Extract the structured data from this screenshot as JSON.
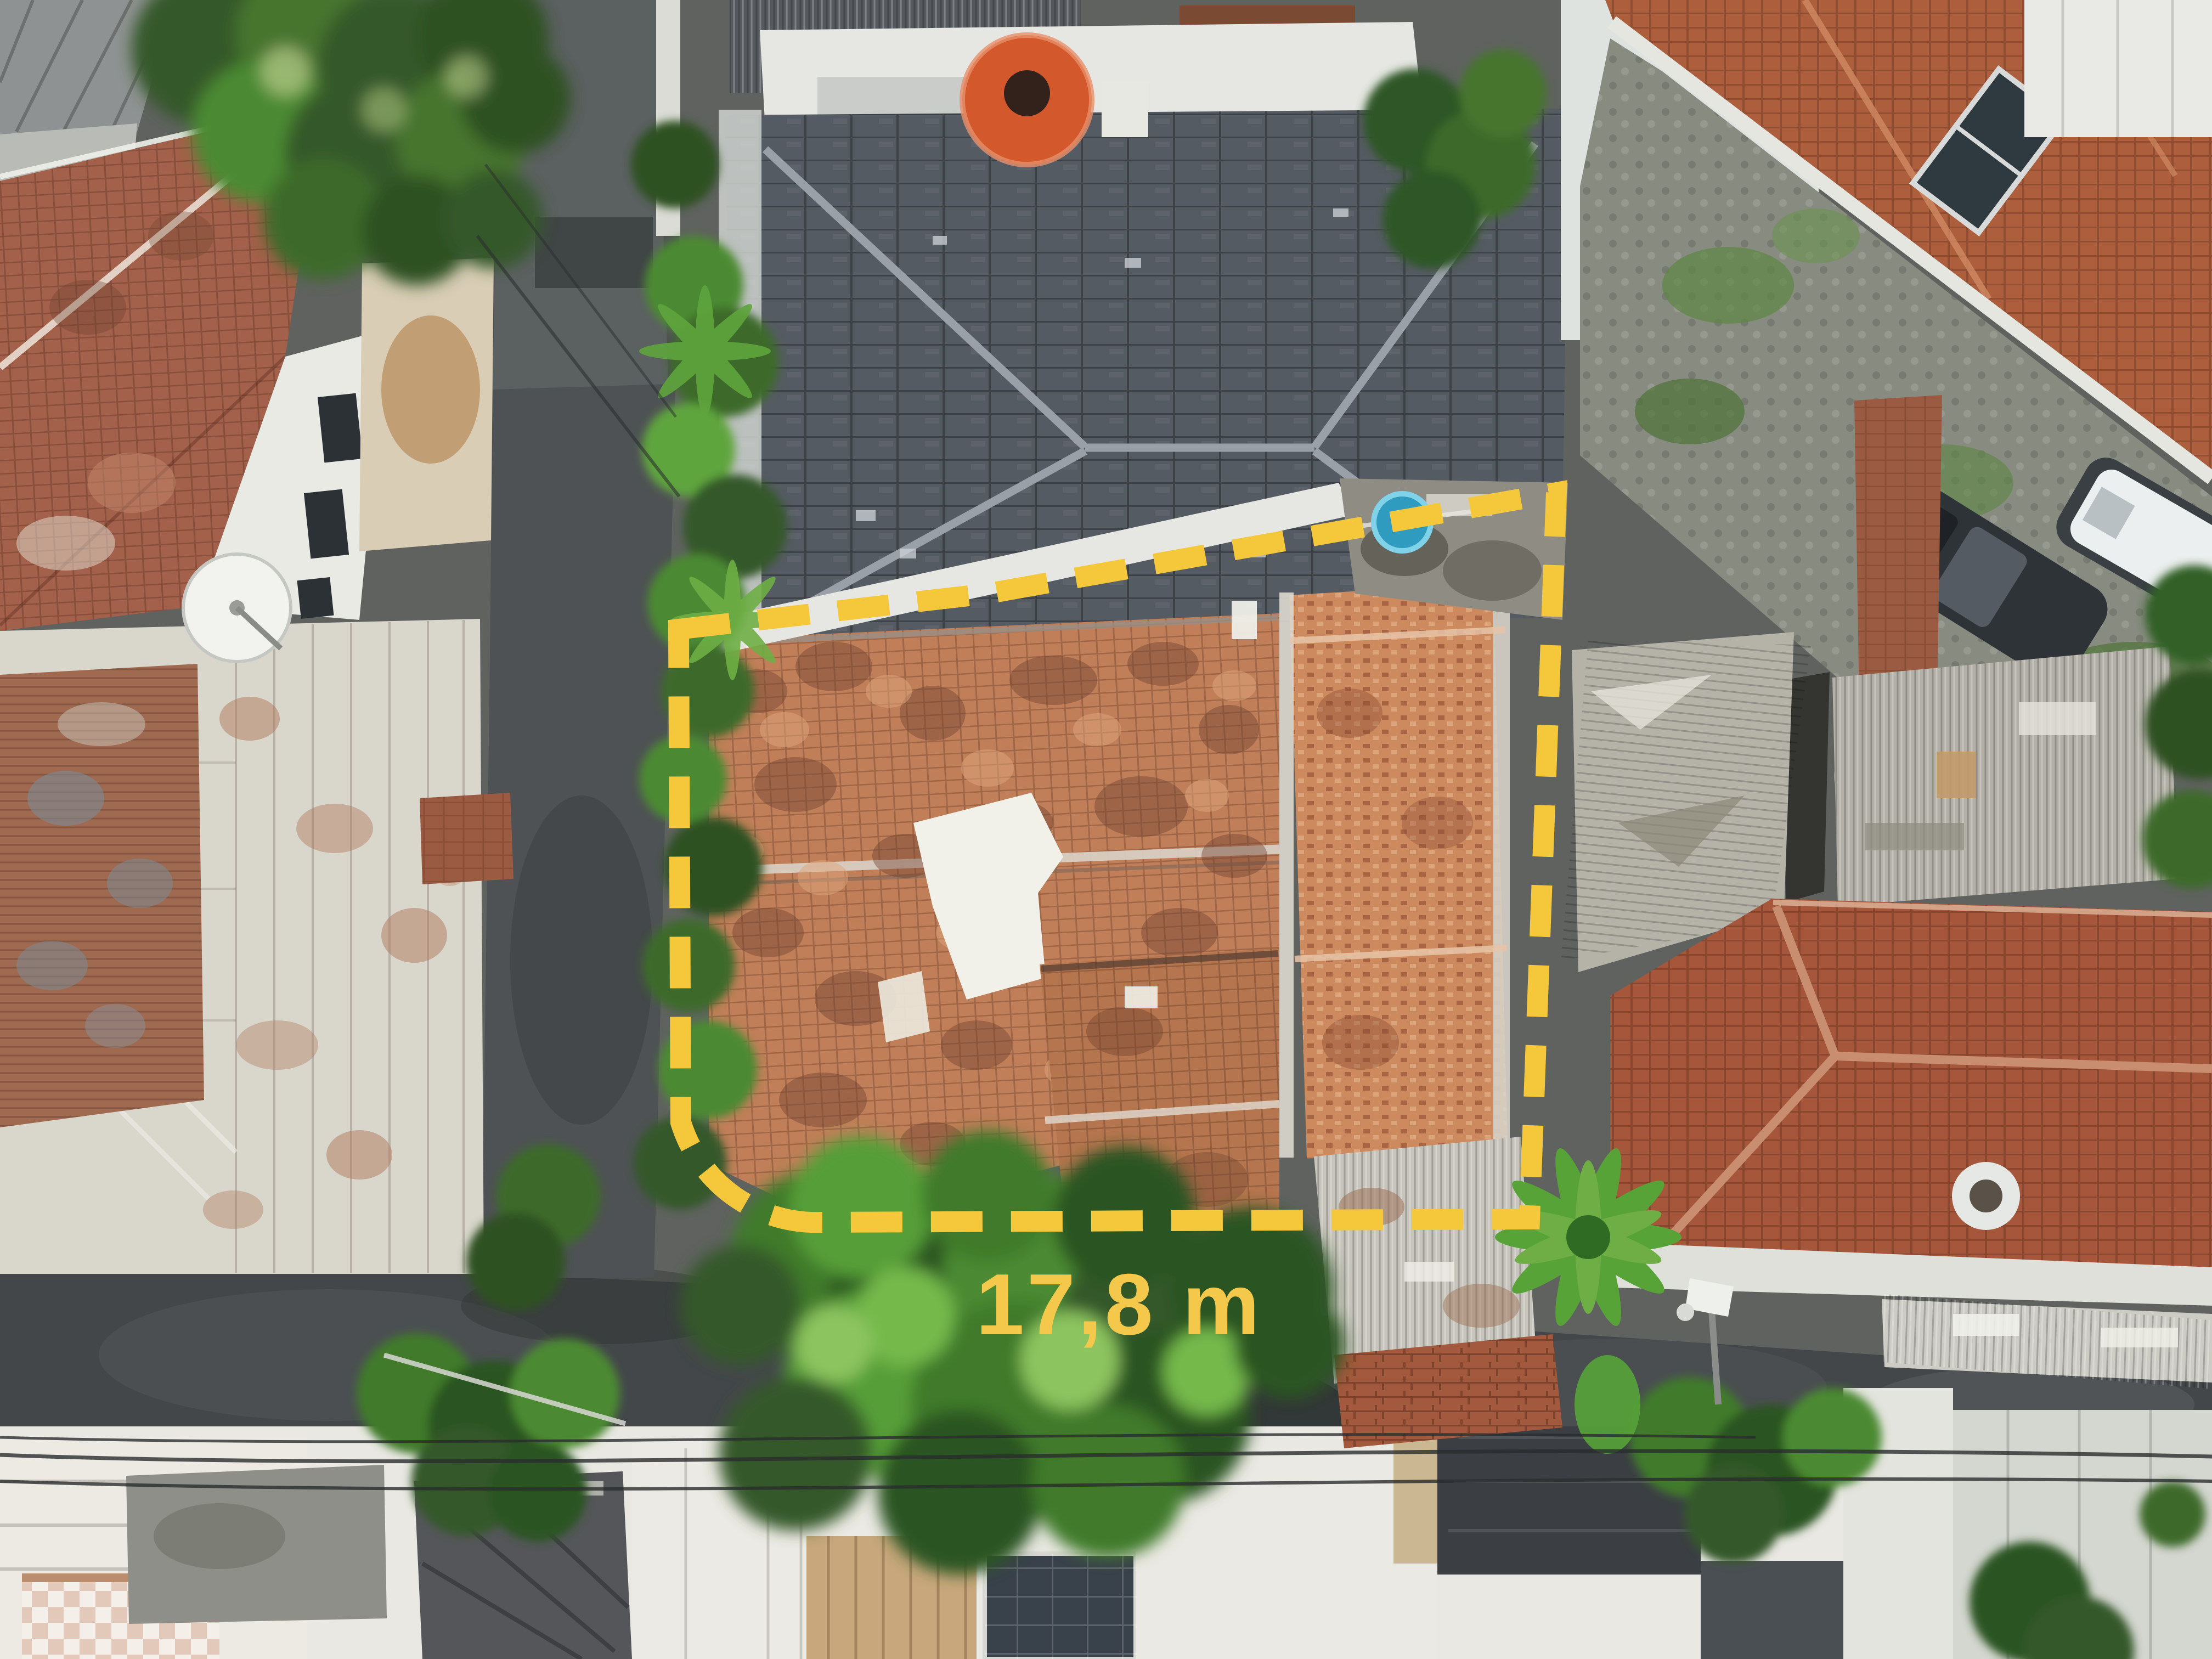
{
  "page": {
    "kind": "aerial-drone-photo",
    "subject": "top-down view of residential houses with a property lot outlined"
  },
  "annotation": {
    "measurement_label": "17,8 m",
    "label_color": "#F3C84B",
    "boundary_color": "#F5C83C",
    "boundary_style": "dashed",
    "boundary_dash": "94 52"
  },
  "palette": {
    "asphalt_road": "#43474a",
    "alley": "#4e5254",
    "slate_roof": "#555b63",
    "slate_ridge": "#9aa0a8",
    "old_tile_roof": "#c07f58",
    "old_tile_dark": "#6e4130",
    "bright_tile_roof": "#cd8a5e",
    "big_tile_roof": "#a6573b",
    "gable_tile_roof": "#a3604a",
    "weathered_white_roof": "#d9d6cc",
    "rust_corrugated": "#a06a50",
    "corrugated_metal": "#b3b0a7",
    "white_wall": "#e9eae4",
    "foliage_bright": "#6fae45",
    "foliage_mid": "#4c8a33",
    "foliage_dark": "#2e5122",
    "water_tank_orange": "#d3582c",
    "water_tub_blue": "#2f9cbf",
    "tarp_white": "#f1f1ea",
    "cobble_pavement": "#878b80"
  }
}
